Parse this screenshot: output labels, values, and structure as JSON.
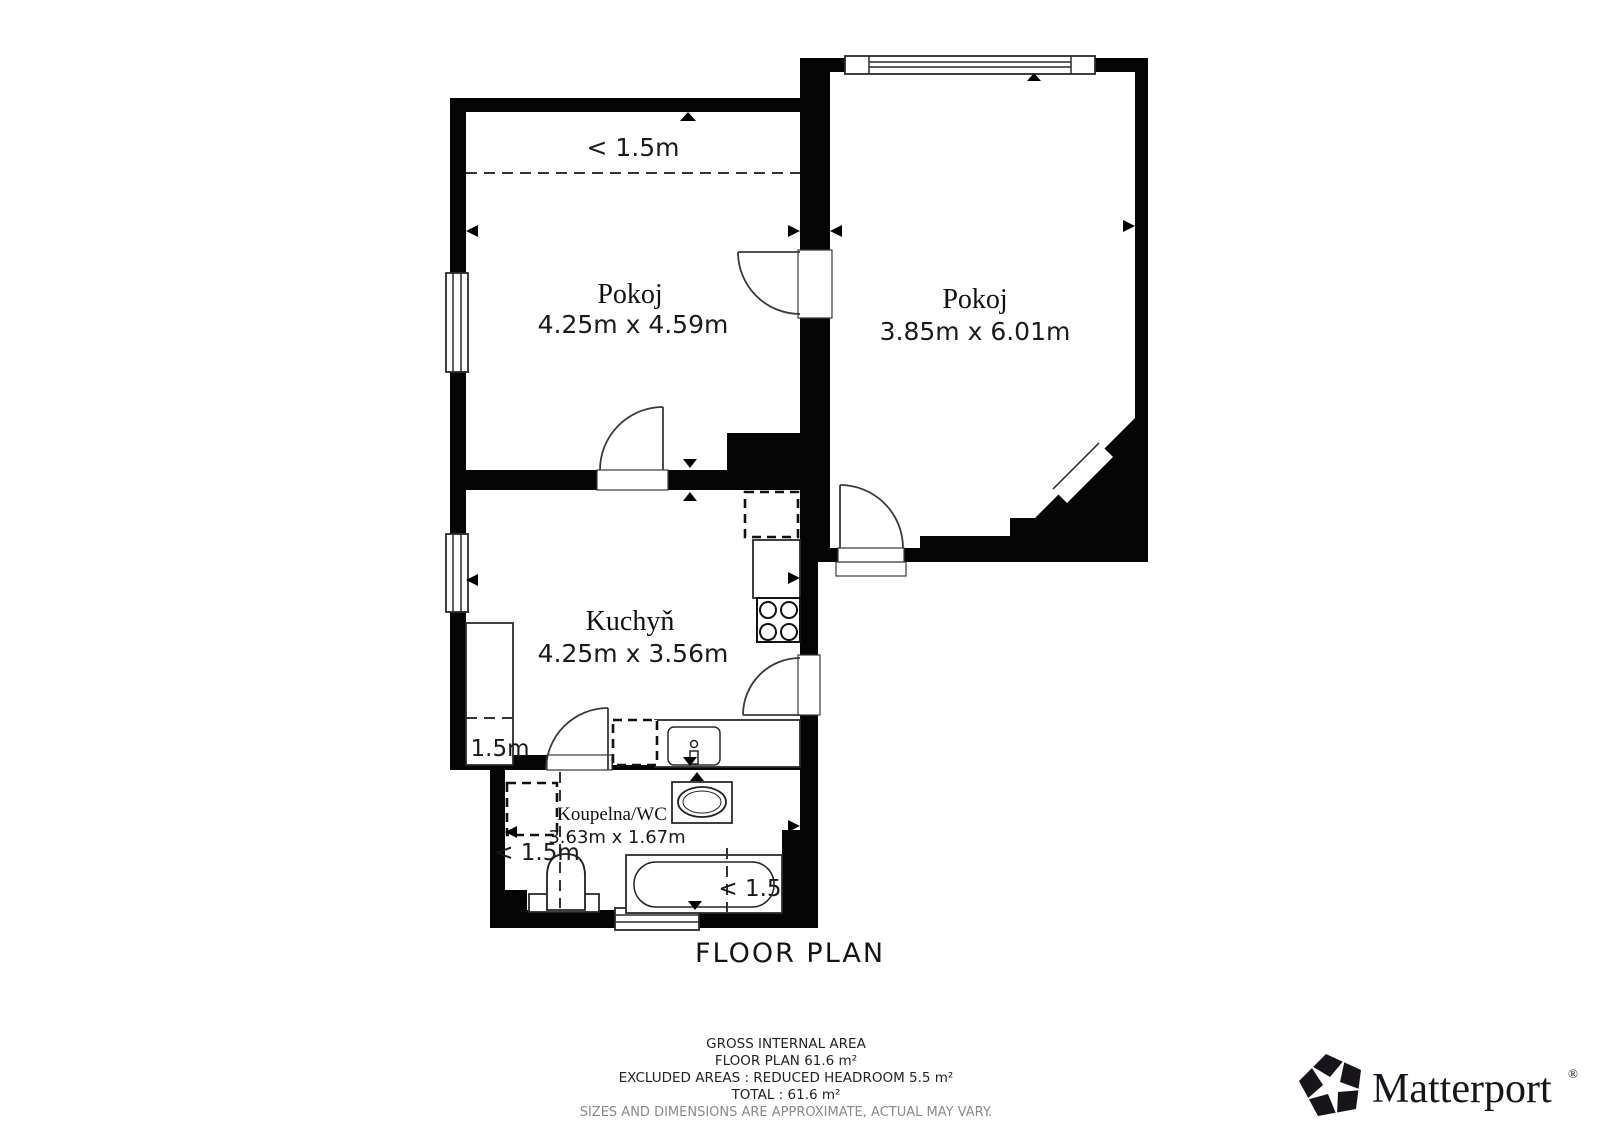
{
  "title": "FLOOR PLAN",
  "rooms": [
    {
      "name": "Pokoj",
      "dims": "4.25m x 4.59m"
    },
    {
      "name": "Pokoj",
      "dims": "3.85m x 6.01m"
    },
    {
      "name": "Kuchyň",
      "dims": "4.25m x 3.56m"
    },
    {
      "name": "Koupelna/WC",
      "dims": "3.63m x 1.67m"
    }
  ],
  "headroom": {
    "room1": "< 1.5m",
    "kitchen": "1.5m",
    "bathroom": "< 1.5m",
    "tub": "< 1.5"
  },
  "footer": {
    "line1": "GROSS INTERNAL AREA",
    "line2": "FLOOR PLAN 61.6 m²",
    "line3": "EXCLUDED AREAS :  REDUCED HEADROOM 5.5 m²",
    "line4": "TOTAL :  61.6 m²",
    "disclaimer": "SIZES AND DIMENSIONS ARE APPROXIMATE, ACTUAL MAY VARY."
  },
  "branding": {
    "name": "Matterport",
    "registered": "®"
  },
  "colors": {
    "wall": "#000000",
    "line": "#333333",
    "text": "#1a1a1a",
    "muted": "#8a8a8a"
  }
}
